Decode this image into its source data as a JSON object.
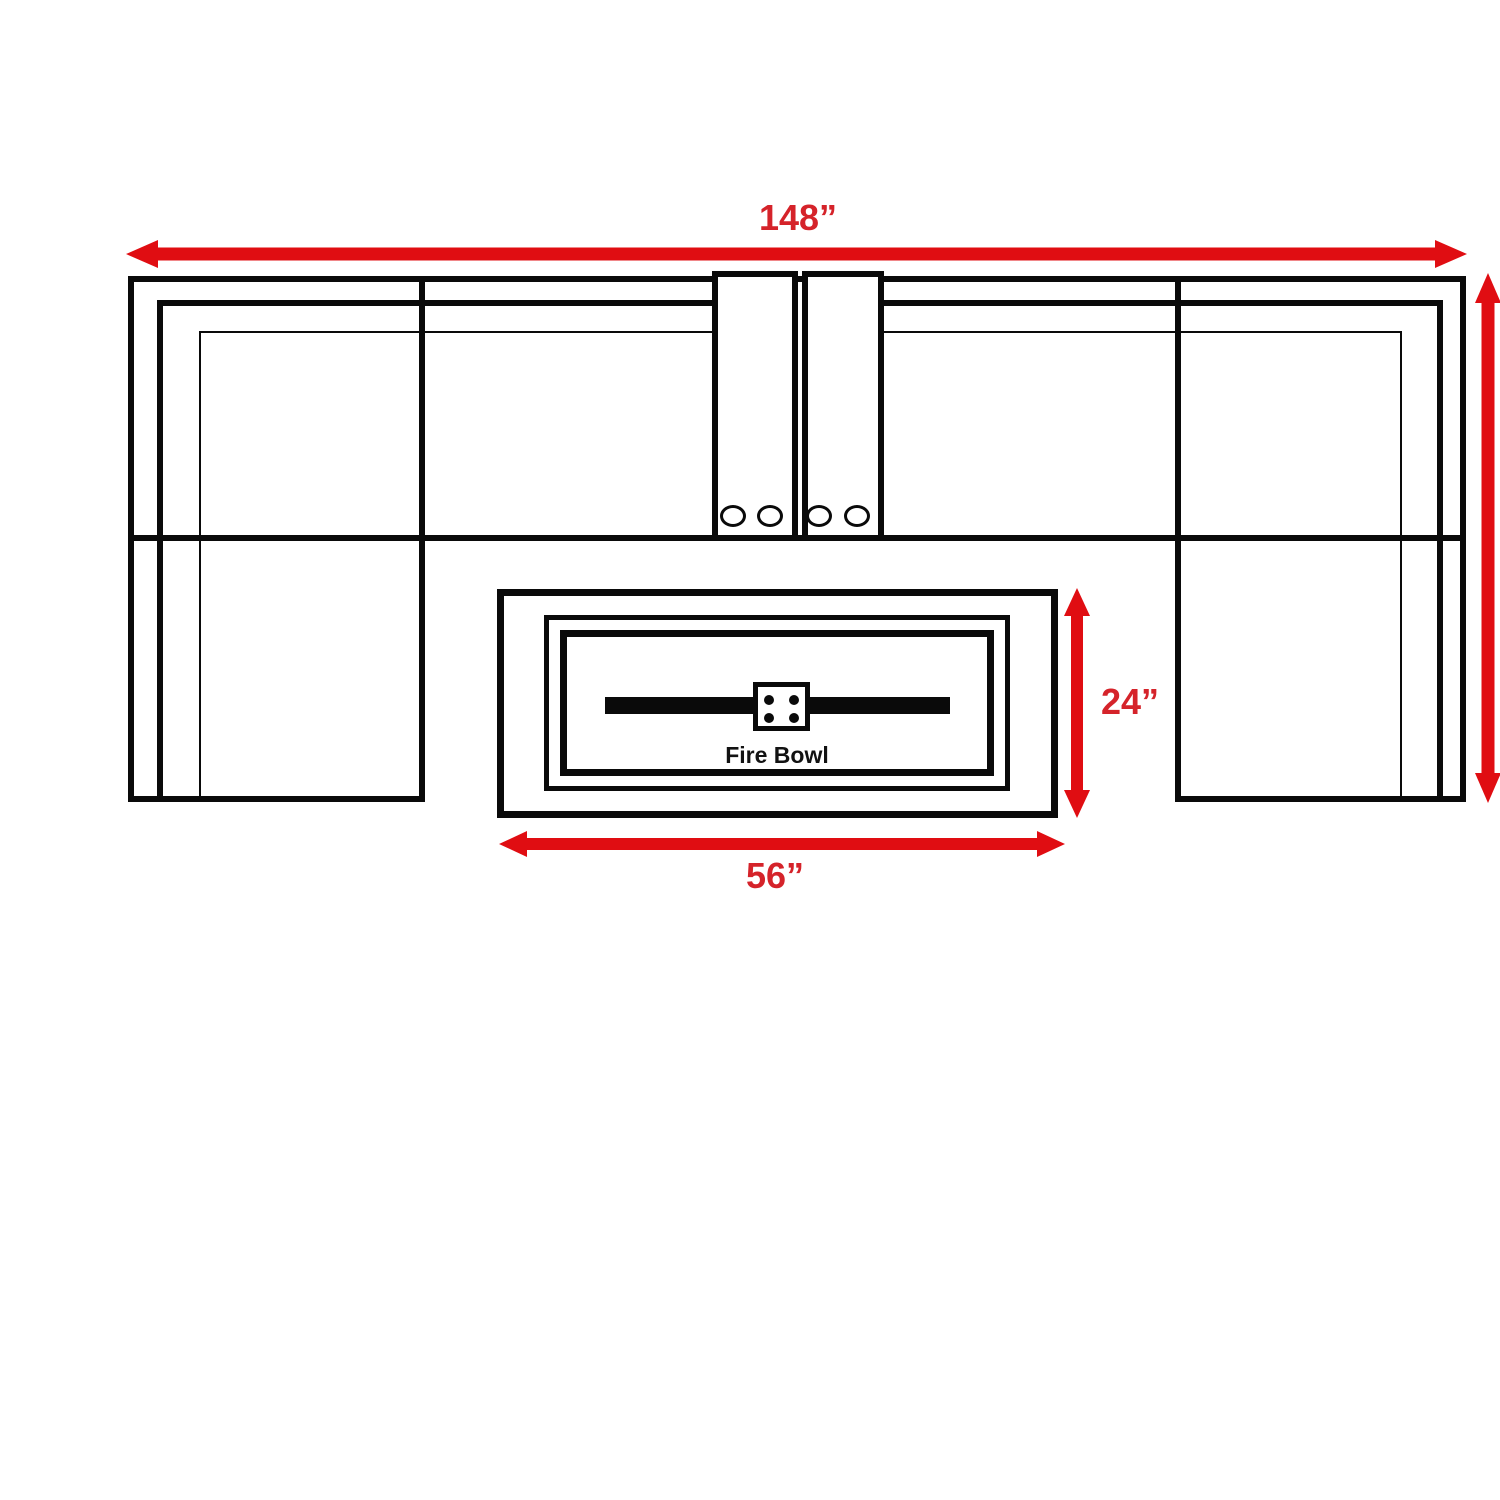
{
  "diagram": {
    "dimension_labels": {
      "overall_width": "148”",
      "fire_table_depth": "24”",
      "fire_table_width": "56”"
    },
    "fire_table": {
      "label": "Fire Bowl"
    },
    "colors": {
      "dimension_arrow": "#e00d12",
      "dimension_text": "#d5232a",
      "outline": "#0a0a0a",
      "background": "#ffffff"
    },
    "components": [
      "left-chaise-section",
      "middle-left-seat",
      "console-left",
      "console-right",
      "middle-right-seat",
      "right-chaise-section",
      "fire-bowl-table"
    ],
    "cup_holders": 4
  }
}
